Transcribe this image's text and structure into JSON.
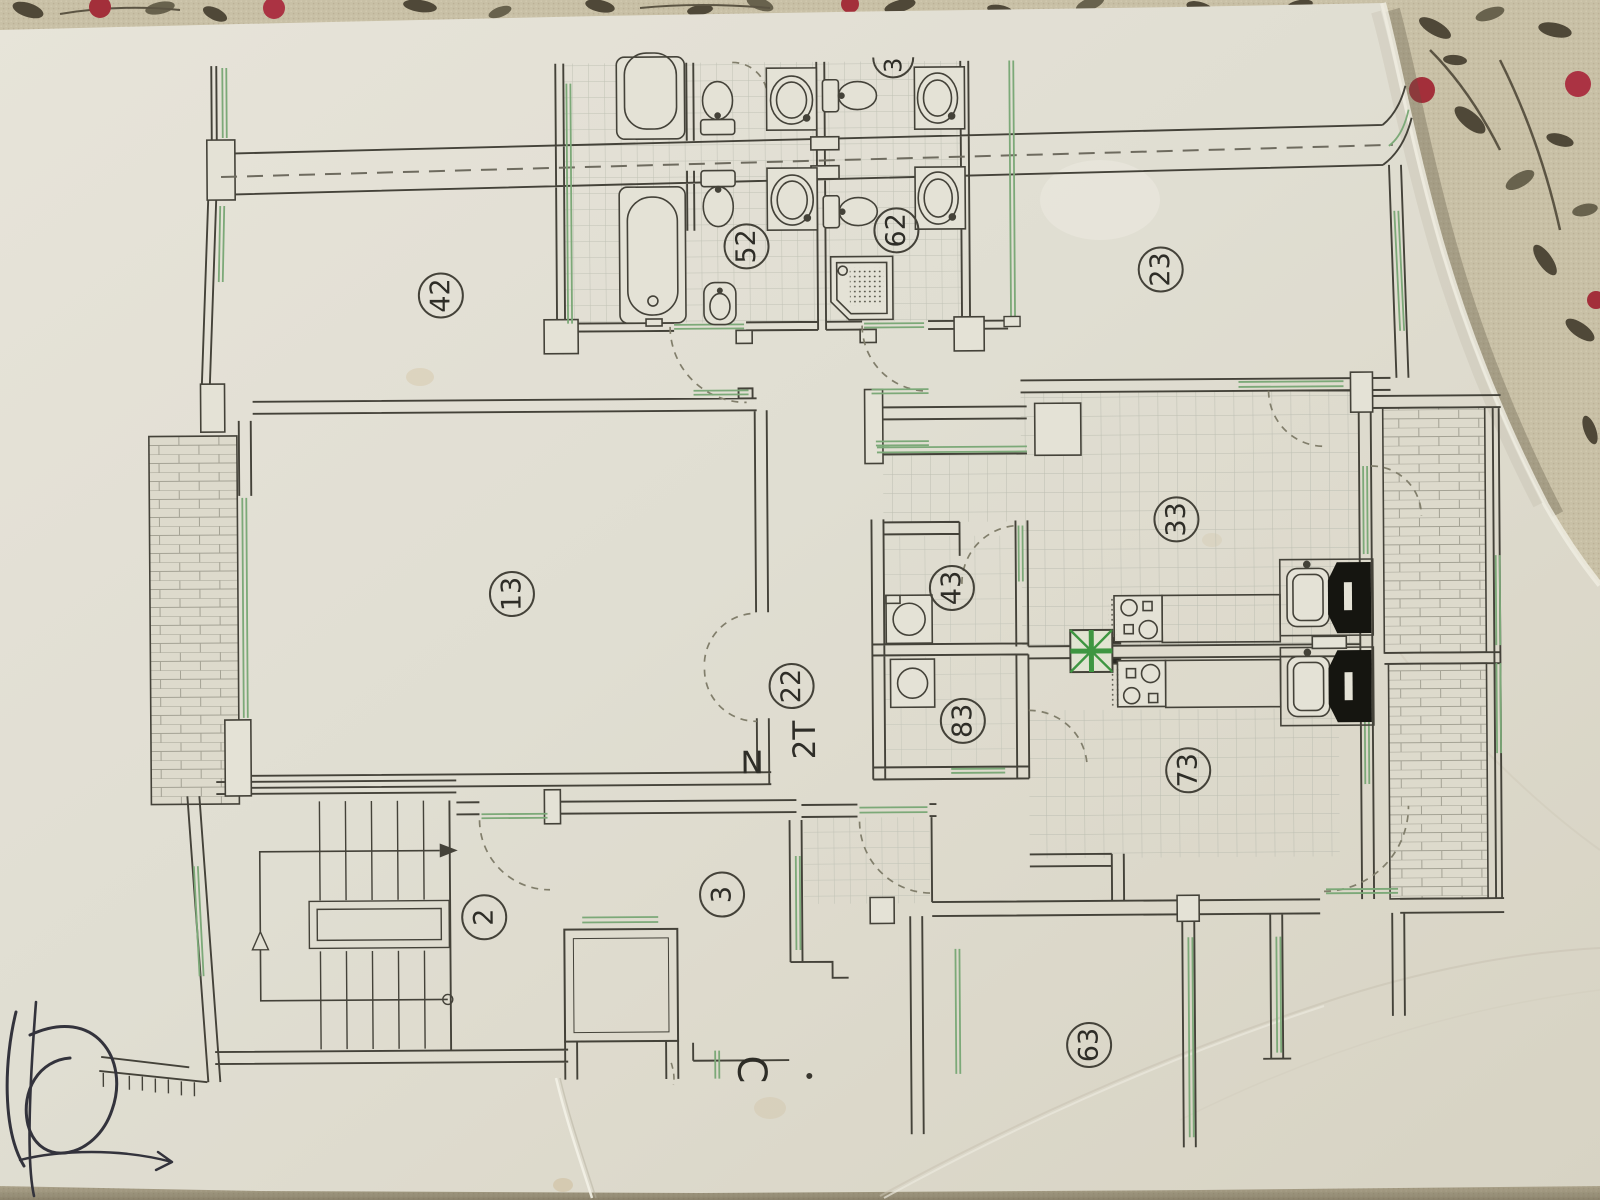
{
  "floorplan": {
    "rooms": [
      {
        "id": "room-24",
        "number": "24",
        "x": 443,
        "y": 293
      },
      {
        "id": "room-25",
        "number": "25",
        "x": 749,
        "y": 246
      },
      {
        "id": "room-26",
        "number": "26",
        "x": 899,
        "y": 231
      },
      {
        "id": "room-32",
        "number": "32",
        "x": 1163,
        "y": 272
      },
      {
        "id": "room-31",
        "number": "31",
        "x": 512,
        "y": 592
      },
      {
        "id": "room-33",
        "number": "33",
        "x": 1177,
        "y": 522
      },
      {
        "id": "room-34",
        "number": "34",
        "x": 952,
        "y": 589
      },
      {
        "id": "room-22",
        "number": "22",
        "x": 791,
        "y": 686
      },
      {
        "id": "room-38",
        "number": "38",
        "x": 962,
        "y": 722
      },
      {
        "id": "room-37",
        "number": "37",
        "x": 1187,
        "y": 773
      },
      {
        "id": "room-2",
        "number": "2",
        "x": 482,
        "y": 915
      },
      {
        "id": "room-3",
        "number": "3",
        "x": 720,
        "y": 894
      },
      {
        "id": "room-36",
        "number": "36",
        "x": 1086,
        "y": 1047
      }
    ],
    "annotations": [
      {
        "id": "unit-type-label",
        "text": "T2",
        "x": 804,
        "y": 740,
        "rotate": -90,
        "size": 31
      },
      {
        "id": "north-label",
        "text": "N",
        "x": 751,
        "y": 763,
        "rotate": 0,
        "size": 31
      },
      {
        "id": "letter-c-label",
        "text": "C",
        "x": 748,
        "y": 1069,
        "rotate": 90,
        "size": 40
      },
      {
        "id": "partial-top-label",
        "text": "3",
        "x": 897,
        "y": 66,
        "rotate": -90,
        "size": 24,
        "partial": true
      }
    ],
    "colors": {
      "paper": "#e9e6db",
      "plan_line": "#45433b",
      "window_green": "#7fae7c",
      "shaft_green": "#3f9b43",
      "tile_line": "#c3c5ba",
      "fabric": "#cfc6ac",
      "berry_red": "#a82f3c",
      "leaf_dark": "#51493a",
      "ink_scribble": "#34333e"
    }
  }
}
